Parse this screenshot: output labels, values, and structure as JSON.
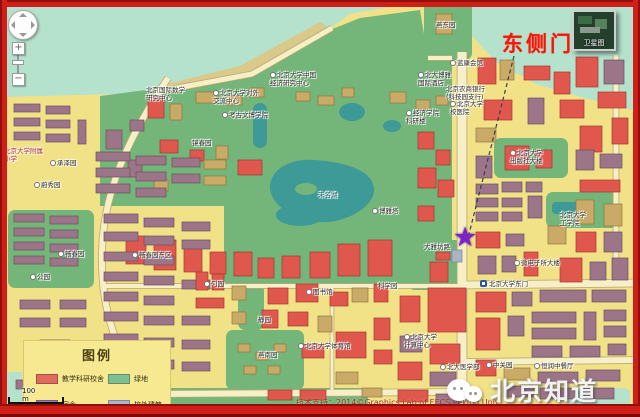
{
  "annotation": {
    "text": "东侧门",
    "color": "#f81408"
  },
  "marker": {
    "shape": "star",
    "glyph": "★",
    "color": "#7e22c3"
  },
  "satellite_thumb": {
    "label": "卫星图"
  },
  "scale": {
    "metric": "100 m",
    "imperial": "200 ft"
  },
  "watermark": {
    "text": "北京知道"
  },
  "credit": {
    "text": "技术支持：2014©Graphics Lab of EECS,Peking Univ"
  },
  "controls": {
    "zoom_in": "+",
    "zoom_out": "−"
  },
  "legend": {
    "title": "图例",
    "items": [
      {
        "label": "教学科研校舍",
        "color": "#df6a5e"
      },
      {
        "label": "绿地",
        "color": "#7fbe8e"
      },
      {
        "label": "宿舍",
        "color": "#9b7bad"
      },
      {
        "label": "校外建筑",
        "color": "#a9b6c9"
      }
    ]
  },
  "colors": {
    "land": "#f1e288",
    "water": "#b4e2cc",
    "lake": "#3e9a96",
    "green": "#74b579",
    "building_red": "#e0574e",
    "building_dorm": "#9c7588",
    "building_tan": "#c9aa66",
    "building_gray": "#aab4c4",
    "frame": "#d01e18"
  },
  "map": {
    "labels": [
      {
        "text": "北京大学中国\n经济研究中心",
        "x": 270,
        "y": 72,
        "marker": true
      },
      {
        "text": "北京大学对外\n交流中心",
        "x": 213,
        "y": 90,
        "marker": true
      },
      {
        "text": "考古文博学院",
        "x": 222,
        "y": 112,
        "marker": true
      },
      {
        "text": "北京国际数学\n研究中心",
        "x": 146,
        "y": 87
      },
      {
        "text": "未名湖",
        "x": 318,
        "y": 192,
        "color": "#1e5e66"
      },
      {
        "text": "博雅塔",
        "x": 372,
        "y": 208,
        "marker": true
      },
      {
        "text": "图书馆",
        "x": 306,
        "y": 289,
        "marker": true
      },
      {
        "text": "科学园",
        "x": 378,
        "y": 283
      },
      {
        "text": "静园",
        "x": 258,
        "y": 317
      },
      {
        "text": "燕南园",
        "x": 258,
        "y": 352
      },
      {
        "text": "勺园",
        "x": 204,
        "y": 281,
        "marker": true
      },
      {
        "text": "承泽园",
        "x": 50,
        "y": 160,
        "marker": true
      },
      {
        "text": "蔚秀园",
        "x": 34,
        "y": 182,
        "marker": true
      },
      {
        "text": "畅春园",
        "x": 58,
        "y": 251,
        "marker": true
      },
      {
        "text": "畅春园东区",
        "x": 132,
        "y": 252,
        "marker": true
      },
      {
        "text": "公园",
        "x": 30,
        "y": 274,
        "marker": true
      },
      {
        "text": "北京大学附属\n小学",
        "x": 4,
        "y": 148,
        "color": "#b52a20"
      },
      {
        "text": "燕东园",
        "x": 436,
        "y": 22
      },
      {
        "text": "蓝康会馆",
        "x": 450,
        "y": 60,
        "marker": true
      },
      {
        "text": "北大博雅\n国际酒店",
        "x": 418,
        "y": 72,
        "marker": true
      },
      {
        "text": "北京农商银行\n(科技园支行)",
        "x": 446,
        "y": 86
      },
      {
        "text": "北京大学\n校医院",
        "x": 450,
        "y": 101,
        "marker": true
      },
      {
        "text": "经济学院\n科研楼",
        "x": 406,
        "y": 110,
        "marker": true
      },
      {
        "text": "镜春园",
        "x": 192,
        "y": 140
      },
      {
        "text": "北京大学\n出版社大楼",
        "x": 510,
        "y": 150,
        "marker": true
      },
      {
        "text": "北京大学\n工学院",
        "x": 560,
        "y": 212
      },
      {
        "text": "微电子所大楼",
        "x": 514,
        "y": 260,
        "marker": true
      },
      {
        "text": "北京大学东门",
        "x": 480,
        "y": 280,
        "station": true
      },
      {
        "text": "大雅坊路",
        "x": 424,
        "y": 244
      },
      {
        "text": "北京大学\n计算中心",
        "x": 404,
        "y": 334,
        "marker": true
      },
      {
        "text": "北京大学体育馆",
        "x": 298,
        "y": 343,
        "marker": true
      },
      {
        "text": "中关园",
        "x": 486,
        "y": 362,
        "marker": true
      },
      {
        "text": "北大医学部",
        "x": 440,
        "y": 364,
        "marker": true
      },
      {
        "text": "恒润中餐厅",
        "x": 534,
        "y": 363,
        "marker": true
      }
    ]
  }
}
